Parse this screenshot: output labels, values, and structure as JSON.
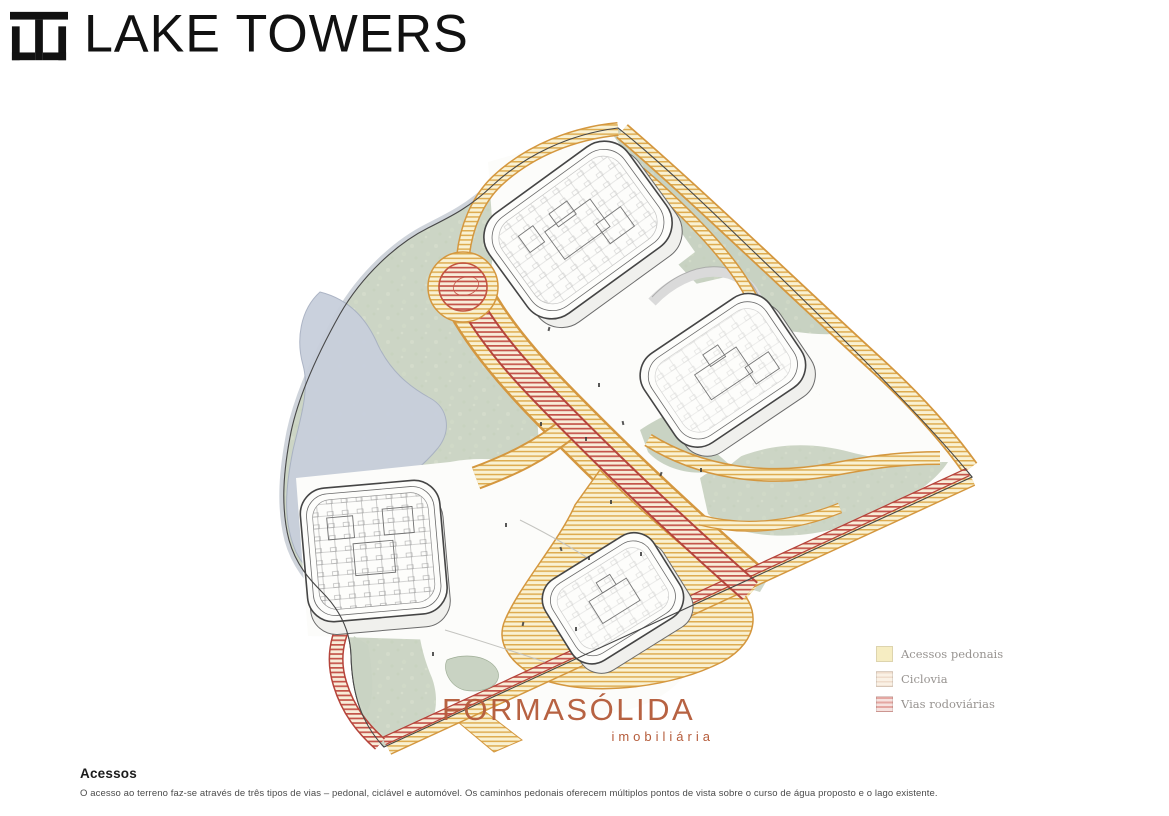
{
  "header": {
    "brand": "LAKE TOWERS",
    "logo_icon": "lt-monogram-icon"
  },
  "legend": {
    "items": [
      {
        "id": "pedestrian",
        "label": "Acessos pedonais",
        "swatch_color": "#f6edc2"
      },
      {
        "id": "cycleway",
        "label": "Ciclovia",
        "swatch_color": "#faf1e5"
      },
      {
        "id": "roads",
        "label": "Vias rodoviárias",
        "swatch_color": "#f6e2df"
      }
    ]
  },
  "watermark": {
    "title": "FORMASÓLIDA",
    "subtitle": "imobiliária",
    "color": "#b55c3b"
  },
  "section": {
    "heading": "Acessos",
    "body": "O acesso ao terreno faz-se através de três tipos de vias – pedonal, ciclável e automóvel. Os caminhos pedonais oferecem múltiplos pontos de vista sobre o curso de água proposto e o lago existente."
  },
  "map": {
    "description": "Axonometric masterplan illustration with four residential buildings, lake, pedestrian paths, cycleway and roads",
    "colors": {
      "terrain_green": "#ccd5c5",
      "lake_blue": "#c8cfdc",
      "path_yellow_bg": "#f9f1d2",
      "path_yellow_stripe": "#deac50",
      "path_border_orange": "#d4973f",
      "road_red_stripe": "#c4544a",
      "road_border_red": "#b5443b",
      "building_fill": "#fdfdfb",
      "building_line": "#474747"
    }
  }
}
